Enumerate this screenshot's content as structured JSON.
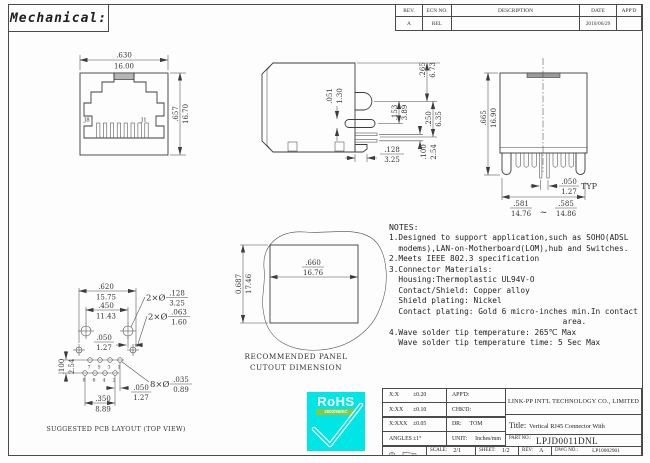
{
  "sheet": {
    "title": "Mechanical:",
    "rev_table": {
      "headers": [
        "REV.",
        "ECN NO.",
        "DESCRIPTION",
        "DATE",
        "APP'D"
      ],
      "row": {
        "rev": "A",
        "ecn": "REL",
        "description": "",
        "date": "2010/06/29",
        "appd": ""
      }
    }
  },
  "front_view": {
    "dim_width": {
      "in": ".630",
      "mm": "16.00"
    },
    "dim_height": {
      "in": ".657",
      "mm": "16.70"
    },
    "pin_label_left": "J8",
    "pin_label_right": "J1"
  },
  "side_view": {
    "dim_top_to_latch": {
      "in": ".265",
      "mm": "6.73"
    },
    "dim_slot_thickness": {
      "in": ".051",
      "mm": "1.30"
    },
    "dim_latch_to_slot": {
      "in": ".153",
      "mm": "3.89"
    },
    "dim_latch_to_pin": {
      "in": ".250",
      "mm": "6.35"
    },
    "dim_post_length": {
      "in": ".128",
      "mm": "3.25"
    },
    "dim_pin_row_pitch": {
      "in": ".100",
      "mm": "2.54"
    }
  },
  "rear_view": {
    "dim_height": {
      "in": ".665",
      "mm": "16.90"
    },
    "dim_pin_pitch": {
      "in": ".050",
      "mm": "1.27"
    },
    "pin_pitch_suffix": "TYP",
    "dim_width_min": {
      "in": ".581",
      "mm": "14.76"
    },
    "dim_width_max": {
      "in": ".585",
      "mm": "14.86"
    },
    "range_separator": "~"
  },
  "panel_cutout": {
    "dim_width": {
      "in": ".660",
      "mm": "16.76"
    },
    "dim_height": {
      "in": "0.687",
      "mm": "17.46"
    },
    "caption_line1": "RECOMMENDED PANEL",
    "caption_line2": "CUTOUT DIMENSION"
  },
  "pcb_layout": {
    "dim_lower_hole_span": {
      "in": ".620",
      "mm": "15.75"
    },
    "dim_upper_hole_span": {
      "in": ".450",
      "mm": "11.43"
    },
    "dim_hole_row_offset": {
      "in": ".050",
      "mm": "1.27"
    },
    "callout_shield_holes": {
      "prefix": "2×Ø",
      "in": ".128",
      "mm": "3.25"
    },
    "callout_post_holes": {
      "prefix": "2×Ø",
      "in": ".063",
      "mm": "1.60"
    },
    "callout_pin_holes": {
      "prefix": "8×Ø",
      "in": ".035",
      "mm": "0.89"
    },
    "dim_row_pitch": {
      "in": ".100",
      "mm": "2.54"
    },
    "dim_pin_stagger": {
      "in": ".050",
      "mm": "1.27"
    },
    "dim_pin_span": {
      "in": ".350",
      "mm": "8.89"
    },
    "pin_labels_top": [
      "7",
      "5",
      "3",
      "1"
    ],
    "pin_labels_bottom": [
      "8",
      "6",
      "4",
      "2"
    ],
    "caption": "SUGGESTED PCB LAYOUT (TOP VIEW)"
  },
  "notes": {
    "heading": "NOTES:",
    "lines": [
      "1.Designed to support application,such as SOHO(ADSL",
      "  modems),LAN-on-Motherboard(LOM),hub and Switches.",
      "2.Meets IEEE 802.3 specification",
      "3.Connector Materials:",
      "  Housing:Thermoplastic UL94V-O",
      "  Contact/Shield: Copper alloy",
      "  Shield plating: Nickel",
      "  Contact plating: Gold 6 micro-inches min.In contact",
      "                                     area.",
      "4.Wave solder tip temperature: 265℃ Max",
      "  Wave solder tip temperature time: 5 Sec Max"
    ]
  },
  "rohs": {
    "name": "RoHS",
    "directive": "2002/95/EC"
  },
  "title_block": {
    "tolerances": [
      {
        "label": "X:X",
        "value": "±0.20"
      },
      {
        "label": "X:XX",
        "value": "±0.10"
      },
      {
        "label": "X:XXX",
        "value": "±0.05"
      },
      {
        "label": "ANGLES",
        "value": "±1°"
      }
    ],
    "appd_label": "APP'D:",
    "chkd_label": "CHK'D:",
    "dr_label": "DR:",
    "dr_value": "TOM",
    "unit_label": "UNIT:",
    "unit_value": "Inches/mm",
    "company": "LINK-PP INT'L TECHNOLOGY CO., LIMITED",
    "title_label": "Title:",
    "title_line1": "Vertical RJ45 Connector With",
    "title_line2": "10/100 Magnetic",
    "part_no_label": "PART NO.:",
    "part_no": "LPJD0011DNL",
    "scale_label": "SCALE:",
    "scale_value": "2/1",
    "sheet_label": "SHEET:",
    "sheet_value": "1/2",
    "rev_label": "REV:",
    "rev_value": "A",
    "dwg_label": "DWG NO.:",
    "dwg_value": "LP10002901"
  },
  "colors": {
    "line": "#3c3c3c",
    "rohs_cyan": "#00e5e6",
    "rohs_green": "#8dc63f",
    "paper": "#fdfdfd"
  }
}
